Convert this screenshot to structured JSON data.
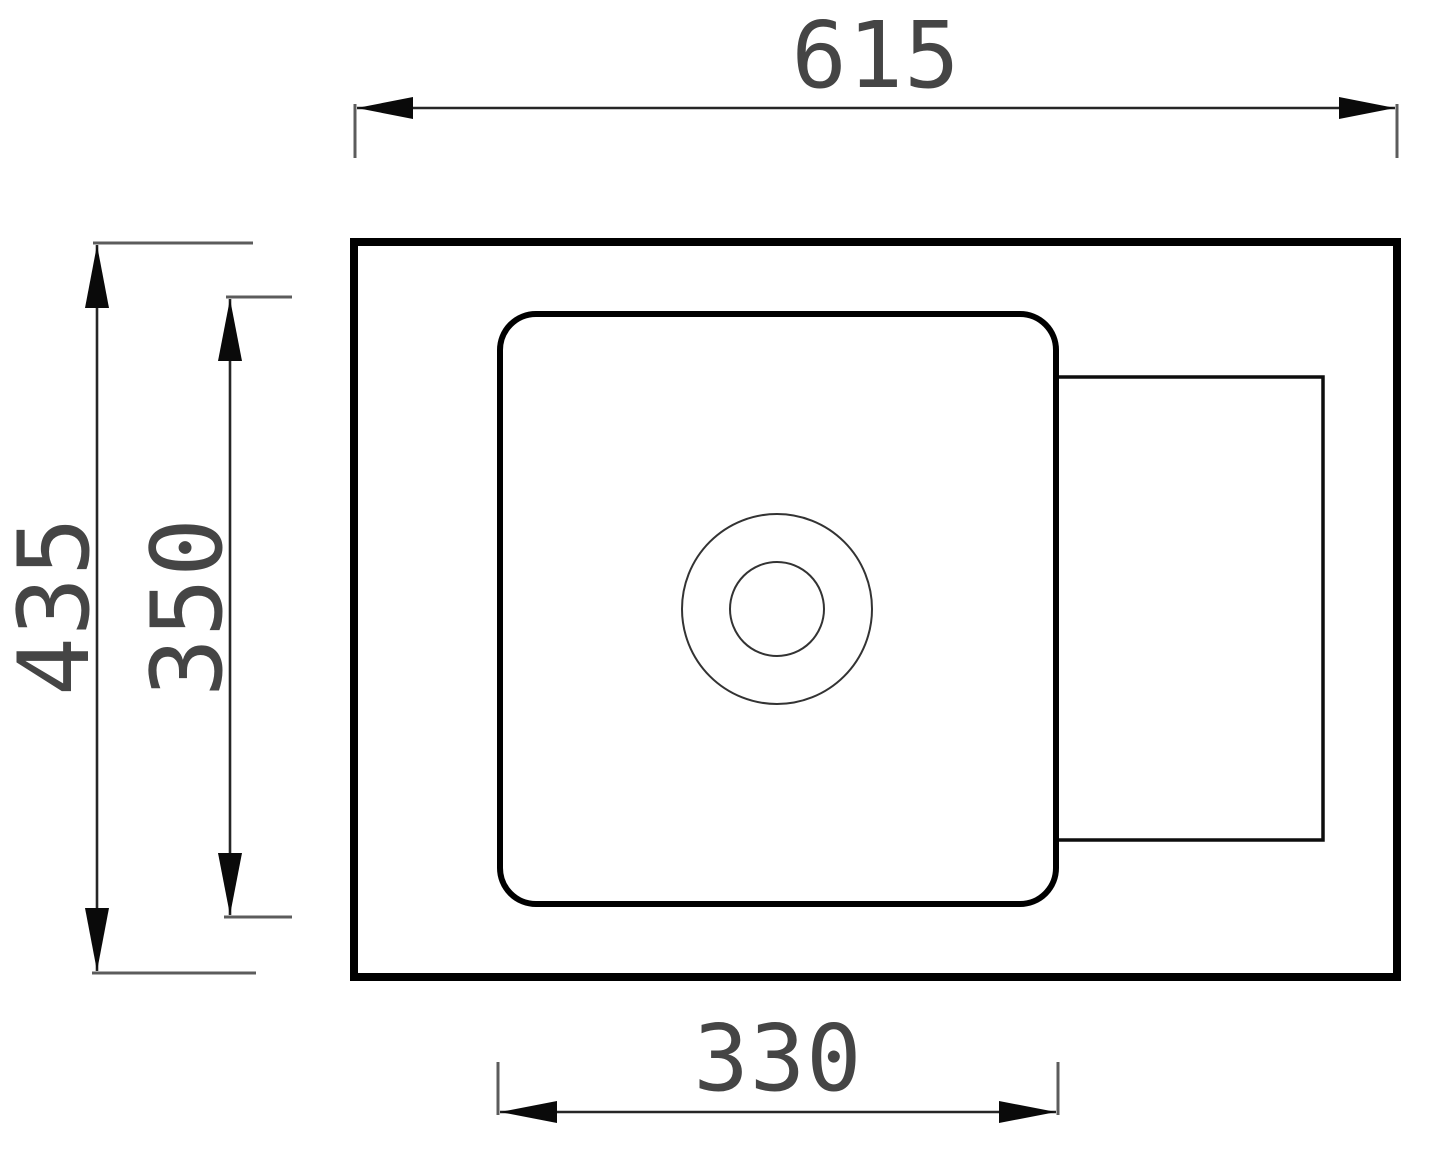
{
  "drawing": {
    "type": "technical-dimension-drawing",
    "subject": "sink-top-view"
  },
  "dimensions": {
    "overall_width": {
      "label": "615"
    },
    "overall_height": {
      "label": "435"
    },
    "bowl_height": {
      "label": "350"
    },
    "bowl_width": {
      "label": "330"
    }
  },
  "colors": {
    "background": "#ffffff",
    "outline": "#000000",
    "dimension_line": "#262626",
    "extension_line": "#5c5c5c",
    "arrow": "#0a0a0a",
    "label_text": "#454545"
  }
}
